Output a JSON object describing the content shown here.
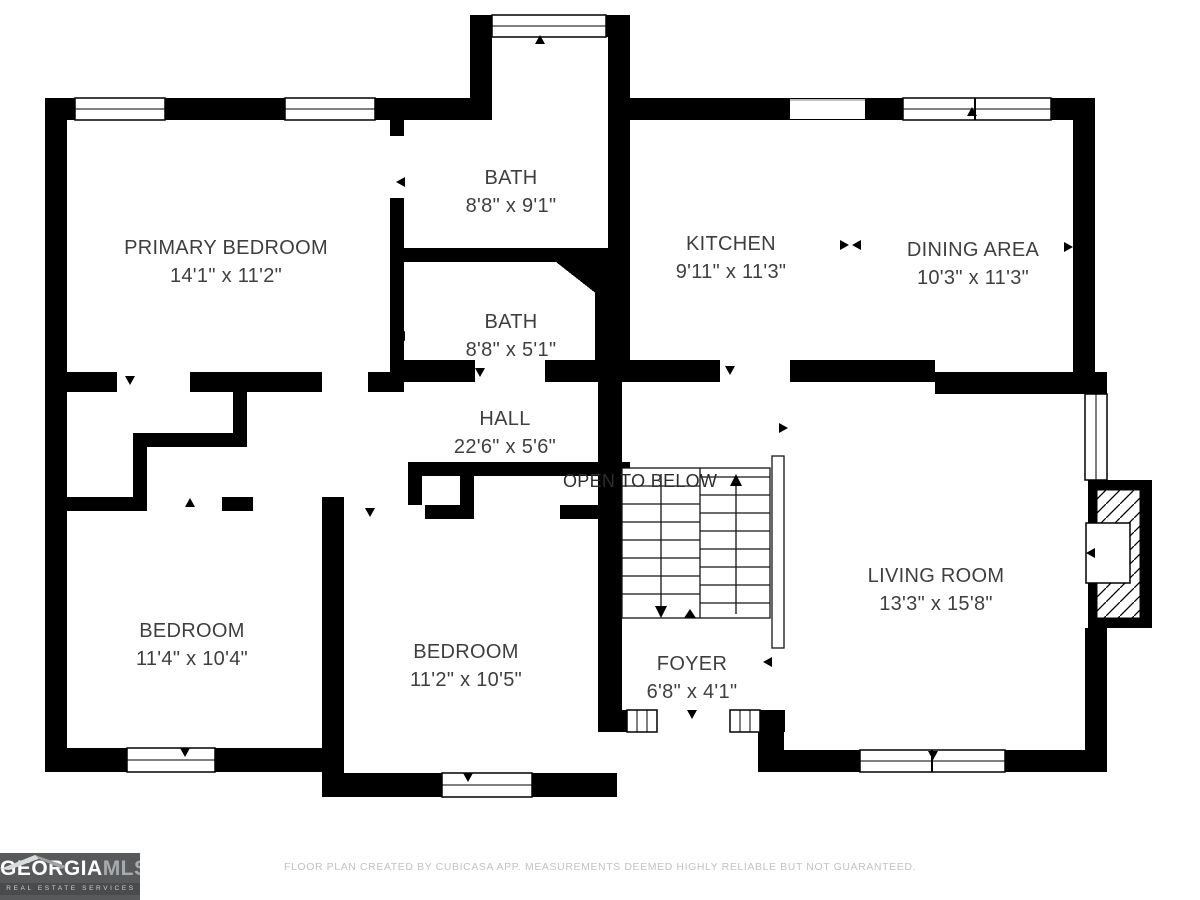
{
  "plan": {
    "rooms": [
      {
        "name": "PRIMARY BEDROOM",
        "dims": "14'1\" x 11'2\""
      },
      {
        "name": "BATH",
        "dims": "8'8\" x 9'1\""
      },
      {
        "name": "BATH",
        "dims": "8'8\" x 5'1\""
      },
      {
        "name": "KITCHEN",
        "dims": "9'11\" x 11'3\""
      },
      {
        "name": "DINING AREA",
        "dims": "10'3\" x 11'3\""
      },
      {
        "name": "HALL",
        "dims": "22'6\" x 5'6\""
      },
      {
        "name": "BEDROOM",
        "dims": "11'4\" x 10'4\""
      },
      {
        "name": "BEDROOM",
        "dims": "11'2\" x 10'5\""
      },
      {
        "name": "FOYER",
        "dims": "6'8\" x 4'1\""
      },
      {
        "name": "LIVING ROOM",
        "dims": "13'3\" x 15'8\""
      }
    ],
    "annotations": {
      "open_to_below": "OPEN TO BELOW"
    },
    "colors": {
      "wall": "#000000",
      "label": "#3f3f3f",
      "footer_text": "#c2c2c2",
      "logo_bg": "#58595b"
    }
  },
  "footer": {
    "disclaimer": "FLOOR PLAN CREATED BY CUBICASA APP. MEASUREMENTS DEEMED HIGHLY RELIABLE BUT NOT GUARANTEED."
  },
  "logo": {
    "brand_primary": "GEORGIA",
    "brand_secondary": "MLS",
    "tagline": "REAL ESTATE SERVICES"
  }
}
